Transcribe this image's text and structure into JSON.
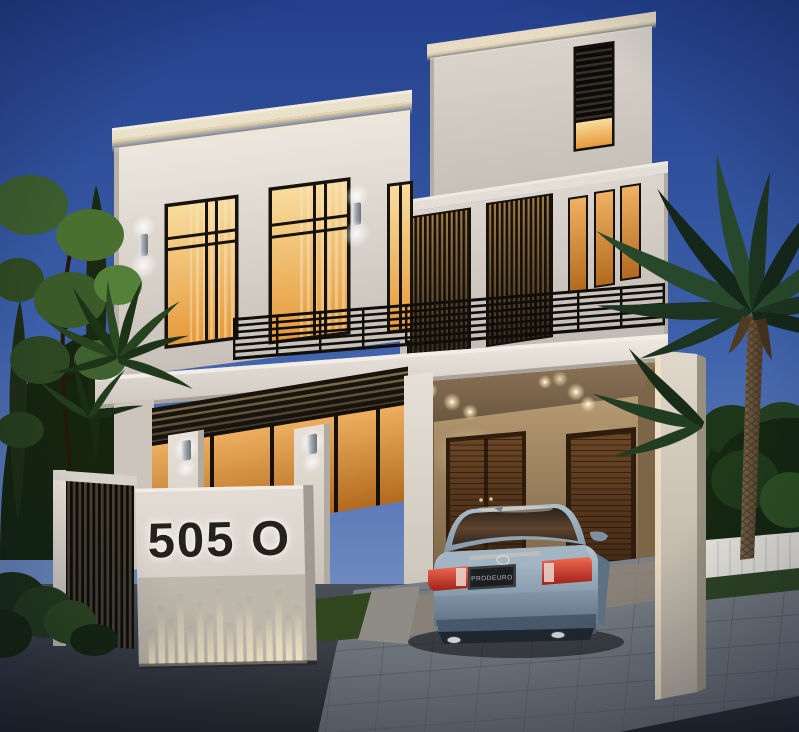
{
  "scene": {
    "description": "Dusk architectural rendering of a modern two-storey white villa with black metal slat screens, warm-lit windows, balcony with horizontal bar railing, covered carport with a parked silver-blue sedan, backlit monument sign wall, slatted fence, trees and palm trees",
    "time_of_day": "dusk"
  },
  "sign": {
    "house_number": "505 O"
  },
  "car": {
    "license_plate": "PRODEURO",
    "description": "silver-blue sedan, rear view",
    "body_color": "#8ba0b1"
  },
  "palette": {
    "sky_top": "#24408d",
    "sky_bottom": "#8299c7",
    "facade_light": "#e9e4dc",
    "facade_shade": "#c3bdb5",
    "fascia_cream": "#eae1cb",
    "cove_glow": "#ffe7ad",
    "window_warm": "#eda648",
    "frame_black": "#17130e",
    "door_brown": "#5c3a1d",
    "foliage_dark": "#1f3822",
    "road_asphalt": "#31363d",
    "paver_gray": "#757c84",
    "taillight_red": "#c43a34"
  }
}
